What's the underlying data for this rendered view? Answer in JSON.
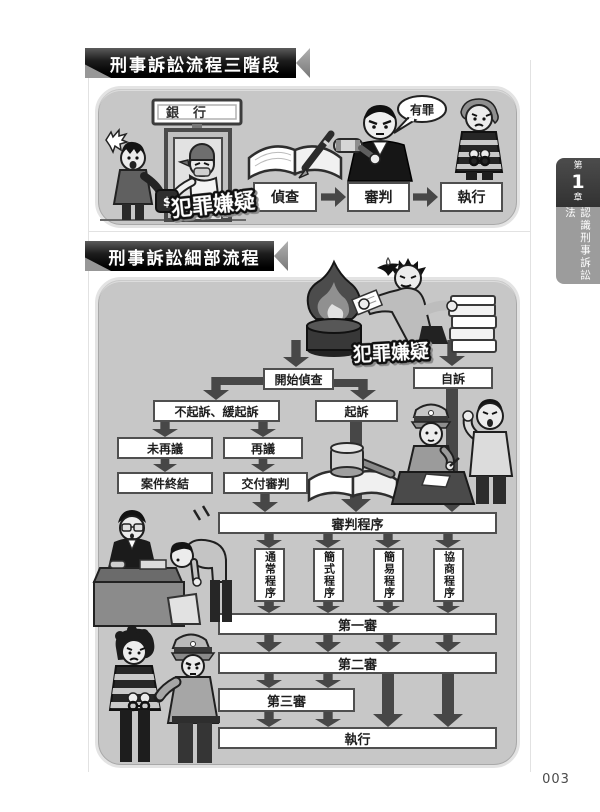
{
  "banners": {
    "section1_title": "刑事訴訟流程三階段",
    "section2_title": "刑事訴訟細部流程"
  },
  "side_tab": {
    "prefix": "第",
    "number": "1",
    "suffix": "章",
    "title": "認識刑事訴訟法"
  },
  "page_number": "003",
  "section1": {
    "bank_sign": "銀行",
    "suspect_label": "犯罪嫌疑",
    "verdict_bubble": "有罪",
    "money_symbol": "$",
    "stages": [
      {
        "label": "偵查"
      },
      {
        "label": "審判"
      },
      {
        "label": "執行"
      }
    ]
  },
  "section2": {
    "suspect_label": "犯罪嫌疑",
    "nodes": {
      "investigation_start": "開始偵查",
      "private_prosecution": "自訴",
      "non_prosecution_deferred": "不起訴、緩起訴",
      "prosecution": "起訴",
      "no_reconsideration": "未再議",
      "reconsideration": "再議",
      "case_closed": "案件終結",
      "refer_to_trial": "交付審判",
      "trial_procedure": "審判程序",
      "ordinary_procedure": "通常程序",
      "simplified_procedure": "簡式程序",
      "summary_procedure": "簡易程序",
      "negotiation_procedure": "協商程序",
      "first_instance": "第一審",
      "second_instance": "第二審",
      "third_instance": "第三審",
      "execution": "執行"
    }
  },
  "colors": {
    "panel_bg": "#c7c7c7",
    "arrow": "#474747",
    "box_border": "#4f4f4f",
    "banner_dark": "#1d1d1d",
    "tab_dark": "#3c3c3c",
    "tab_gray": "#9c9c9c"
  }
}
